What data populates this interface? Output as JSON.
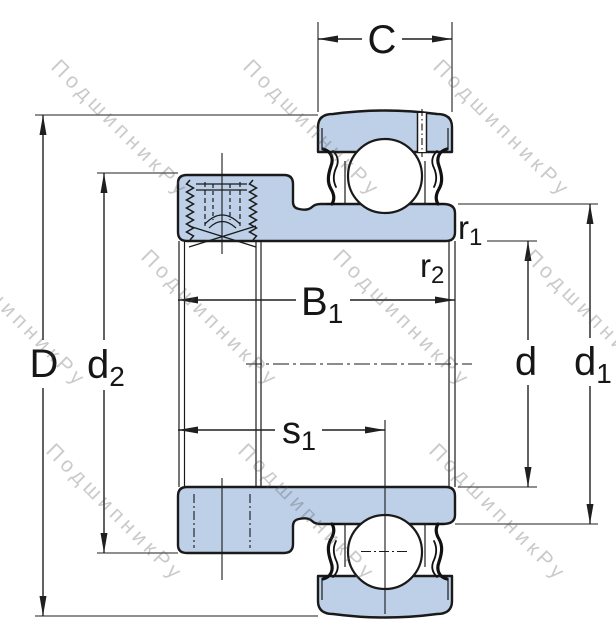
{
  "watermark": {
    "text": "ПодшипникРу"
  },
  "colors": {
    "section_fill": "#bdd0e8",
    "outline": "#1a1a1a",
    "dimension_lines": "#1f1f1f",
    "watermark": "#c6c6c6",
    "background": "#ffffff"
  },
  "dims": {
    "C": {
      "base": "C",
      "sub": ""
    },
    "B1": {
      "base": "B",
      "sub": "1"
    },
    "s1": {
      "base": "s",
      "sub": "1"
    },
    "D": {
      "base": "D",
      "sub": ""
    },
    "d2": {
      "base": "d",
      "sub": "2"
    },
    "d": {
      "base": "d",
      "sub": ""
    },
    "d1": {
      "base": "d",
      "sub": "1"
    },
    "r1": {
      "base": "r",
      "sub": "1"
    },
    "r2": {
      "base": "r",
      "sub": "2"
    }
  }
}
